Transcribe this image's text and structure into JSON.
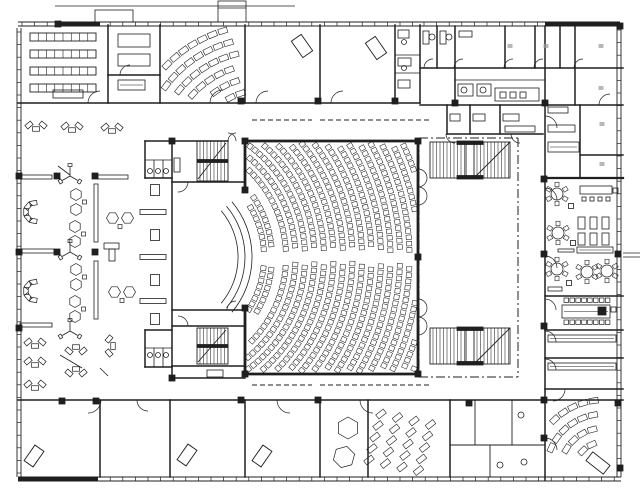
{
  "meta": {
    "canvas_w": 640,
    "canvas_h": 499,
    "ink": "#1f1f1f",
    "paper": "#ffffff",
    "mark": "#9a9a9a",
    "areas": [
      "auditorium",
      "stage",
      "foyer",
      "offices",
      "restaurant",
      "seminar-rooms",
      "sanitary",
      "stair-cores"
    ]
  },
  "facades": [
    {
      "o": "v",
      "p": 19,
      "f": 28,
      "t": 477
    },
    {
      "o": "h",
      "p": 479,
      "f": 18,
      "t": 621
    },
    {
      "o": "v",
      "p": 619,
      "f": 26,
      "t": 477
    },
    {
      "o": "h",
      "p": 24,
      "f": 18,
      "t": 420
    },
    {
      "o": "h",
      "p": 24,
      "f": 420,
      "t": 620
    }
  ],
  "thick": [
    [
      55,
      24,
      100,
      24,
      3
    ],
    [
      545,
      24,
      620,
      24,
      3
    ],
    [
      18,
      479,
      98,
      479,
      4
    ]
  ],
  "walls": [
    [
      18,
      103,
      420,
      103
    ],
    [
      108,
      25,
      108,
      103
    ],
    [
      160,
      25,
      160,
      103
    ],
    [
      108,
      75,
      160,
      75
    ],
    [
      245,
      25,
      245,
      103
    ],
    [
      320,
      25,
      320,
      103
    ],
    [
      395,
      25,
      395,
      103
    ],
    [
      420,
      25,
      420,
      103
    ],
    [
      395,
      55,
      420,
      55,
      0.8
    ],
    [
      395,
      73,
      420,
      73,
      0.8
    ],
    [
      420,
      68,
      623,
      68
    ],
    [
      437,
      26,
      437,
      68
    ],
    [
      455,
      26,
      455,
      105
    ],
    [
      505,
      26,
      505,
      68
    ],
    [
      535,
      26,
      535,
      68
    ],
    [
      560,
      26,
      560,
      68
    ],
    [
      575,
      26,
      575,
      105
    ],
    [
      455,
      80,
      545,
      80,
      0.8
    ],
    [
      420,
      105,
      623,
      105
    ],
    [
      545,
      26,
      545,
      178
    ],
    [
      545,
      178,
      545,
      480
    ],
    [
      447,
      105,
      447,
      134
    ],
    [
      470,
      105,
      470,
      134
    ],
    [
      500,
      105,
      500,
      134
    ],
    [
      447,
      134,
      543,
      134
    ],
    [
      580,
      105,
      580,
      178
    ],
    [
      580,
      155,
      623,
      155
    ],
    [
      545,
      178,
      623,
      178,
      2.2
    ],
    [
      545,
      296,
      623,
      296
    ],
    [
      545,
      330,
      623,
      330
    ],
    [
      545,
      358,
      623,
      358
    ],
    [
      545,
      389,
      623,
      389
    ],
    [
      245,
      141,
      418,
      141,
      2.8
    ],
    [
      418,
      141,
      418,
      374,
      2.8
    ],
    [
      245,
      374,
      418,
      374,
      2.8
    ],
    [
      245,
      141,
      245,
      190,
      2.8
    ],
    [
      245,
      308,
      245,
      374,
      2.8
    ],
    [
      172,
      141,
      172,
      378
    ],
    [
      145,
      141,
      228,
      141
    ],
    [
      243,
      141,
      245,
      141
    ],
    [
      172,
      182,
      245,
      182
    ],
    [
      172,
      310,
      245,
      310
    ],
    [
      172,
      326,
      245,
      326
    ],
    [
      172,
      366,
      245,
      366
    ],
    [
      172,
      378,
      245,
      378
    ],
    [
      145,
      141,
      145,
      178
    ],
    [
      145,
      178,
      172,
      178
    ],
    [
      154,
      160,
      154,
      178,
      0.8
    ],
    [
      163,
      160,
      163,
      178,
      0.8
    ],
    [
      145,
      160,
      172,
      160,
      0.8
    ],
    [
      145,
      330,
      145,
      367
    ],
    [
      145,
      330,
      172,
      330
    ],
    [
      145,
      367,
      172,
      367
    ],
    [
      154,
      348,
      154,
      367,
      0.8
    ],
    [
      163,
      348,
      163,
      367,
      0.8
    ],
    [
      145,
      348,
      172,
      348,
      0.8
    ],
    [
      18,
      400,
      623,
      400
    ],
    [
      100,
      400,
      100,
      477
    ],
    [
      170,
      400,
      170,
      477
    ],
    [
      245,
      400,
      245,
      477
    ],
    [
      320,
      400,
      320,
      477
    ],
    [
      368,
      400,
      368,
      477
    ],
    [
      450,
      400,
      450,
      477
    ],
    [
      475,
      400,
      475,
      445,
      0.9
    ],
    [
      512,
      400,
      512,
      445,
      0.9
    ],
    [
      450,
      445,
      545,
      445,
      0.9
    ],
    [
      490,
      445,
      490,
      477,
      0.9
    ]
  ],
  "dash": [
    [
      252,
      120,
      312,
      120
    ],
    [
      320,
      120,
      430,
      120
    ],
    [
      252,
      385,
      312,
      385
    ],
    [
      320,
      385,
      430,
      385
    ]
  ],
  "dashdot": [
    [
      419,
      138,
      518,
      138
    ],
    [
      518,
      138,
      518,
      377
    ],
    [
      419,
      138,
      419,
      377
    ],
    [
      419,
      377,
      518,
      377
    ]
  ],
  "stairs": [
    {
      "x": 197,
      "y": 141,
      "w": 31,
      "h": 40,
      "gap": 0
    },
    {
      "x": 197,
      "y": 328,
      "w": 31,
      "h": 36,
      "gap": 0
    },
    {
      "x": 430,
      "y": 142,
      "w": 80,
      "h": 36,
      "gap": 1
    },
    {
      "x": 430,
      "y": 328,
      "w": 80,
      "h": 36,
      "gap": 1
    }
  ],
  "rects": [
    [
      95,
      10,
      38,
      12,
      0
    ],
    [
      218,
      1,
      28,
      21,
      0
    ],
    [
      118,
      34,
      32,
      13,
      0
    ],
    [
      118,
      54,
      32,
      12,
      0
    ],
    [
      118,
      80,
      27,
      10,
      1
    ],
    [
      53,
      90,
      30,
      8,
      0
    ],
    [
      423,
      31,
      6,
      13,
      0
    ],
    [
      440,
      31,
      6,
      13,
      0
    ],
    [
      459,
      31,
      13,
      6,
      0
    ],
    [
      458,
      84,
      15,
      12,
      0
    ],
    [
      477,
      84,
      14,
      12,
      0
    ],
    [
      495,
      88,
      44,
      13,
      0
    ],
    [
      500,
      92,
      6,
      6,
      0
    ],
    [
      510,
      92,
      6,
      6,
      0
    ],
    [
      520,
      92,
      6,
      6,
      0
    ],
    [
      450,
      114,
      10,
      7,
      0
    ],
    [
      473,
      114,
      12,
      7,
      0
    ],
    [
      503,
      114,
      16,
      7,
      0
    ],
    [
      505,
      126,
      30,
      6,
      0
    ],
    [
      398,
      30,
      11,
      8,
      0
    ],
    [
      398,
      58,
      13,
      8,
      0
    ],
    [
      398,
      80,
      12,
      8,
      0
    ],
    [
      548,
      107,
      20,
      6,
      0
    ],
    [
      548,
      125,
      27,
      7,
      0
    ],
    [
      548,
      142,
      31,
      10,
      1
    ],
    [
      580,
      186,
      32,
      8,
      0
    ],
    [
      582,
      197,
      4,
      4,
      0
    ],
    [
      590,
      197,
      4,
      4,
      0
    ],
    [
      598,
      197,
      4,
      4,
      0
    ],
    [
      606,
      197,
      4,
      4,
      0
    ],
    [
      613,
      188,
      5,
      5,
      0
    ],
    [
      578,
      217,
      7,
      12,
      0
    ],
    [
      590,
      217,
      7,
      12,
      0
    ],
    [
      602,
      217,
      7,
      12,
      0
    ],
    [
      578,
      233,
      7,
      12,
      0
    ],
    [
      590,
      233,
      7,
      12,
      0
    ],
    [
      602,
      233,
      7,
      12,
      0
    ],
    [
      577,
      247,
      36,
      6,
      1
    ],
    [
      558,
      249,
      16,
      3,
      0
    ],
    [
      562,
      305,
      48,
      13,
      1
    ],
    [
      598,
      307,
      8,
      8,
      2
    ],
    [
      611,
      307,
      5,
      5,
      0
    ],
    [
      548,
      287,
      14,
      4,
      0
    ],
    [
      548,
      335,
      68,
      7,
      1
    ],
    [
      548,
      363,
      68,
      7,
      1
    ],
    [
      207,
      370,
      16,
      7,
      0
    ],
    [
      174,
      158,
      6,
      14,
      0
    ]
  ],
  "squares": [
    [
      58,
      24
    ],
    [
      241,
      101
    ],
    [
      318,
      101
    ],
    [
      395,
      101
    ],
    [
      455,
      103
    ],
    [
      545,
      103
    ],
    [
      620,
      26
    ],
    [
      19,
      176
    ],
    [
      19,
      252
    ],
    [
      19,
      328
    ],
    [
      57,
      176
    ],
    [
      95,
      176
    ],
    [
      57,
      252
    ],
    [
      95,
      252
    ],
    [
      245,
      141
    ],
    [
      418,
      141
    ],
    [
      418,
      257
    ],
    [
      418,
      374
    ],
    [
      245,
      374
    ],
    [
      245,
      190
    ],
    [
      245,
      308
    ],
    [
      544,
      179
    ],
    [
      544,
      254
    ],
    [
      544,
      326
    ],
    [
      544,
      400
    ],
    [
      544,
      438
    ],
    [
      618,
      254
    ],
    [
      618,
      403
    ],
    [
      620,
      468
    ],
    [
      62,
      401
    ],
    [
      96,
      401
    ],
    [
      241,
      400
    ],
    [
      318,
      400
    ],
    [
      469,
      403
    ],
    [
      172,
      141
    ],
    [
      172,
      378
    ]
  ],
  "marks": [
    [
      510,
      46
    ],
    [
      546,
      46
    ],
    [
      601,
      46
    ],
    [
      601,
      88
    ],
    [
      602,
      124
    ],
    [
      602,
      164
    ]
  ],
  "circles": [
    [
      432,
      37,
      3
    ],
    [
      449,
      37,
      3
    ],
    [
      464,
      90,
      3
    ],
    [
      483,
      90,
      3
    ],
    [
      404,
      42,
      2.5
    ],
    [
      404,
      68,
      2.5
    ],
    [
      150,
      171,
      2.5
    ],
    [
      158,
      171,
      2.5
    ],
    [
      166,
      171,
      2.5
    ],
    [
      150,
      355,
      2.5
    ],
    [
      158,
      355,
      2.5
    ],
    [
      166,
      355,
      2.5
    ],
    [
      521,
      415,
      3
    ],
    [
      500,
      465,
      3
    ],
    [
      524,
      462,
      3
    ]
  ],
  "doors": [
    [
      100,
      103,
      12,
      180,
      270
    ],
    [
      130,
      75,
      10,
      180,
      270
    ],
    [
      223,
      103,
      13,
      180,
      270
    ],
    [
      268,
      103,
      12,
      180,
      270
    ],
    [
      343,
      103,
      12,
      180,
      270
    ],
    [
      236,
      141,
      8,
      180,
      270
    ],
    [
      228,
      141,
      8,
      270,
      360
    ],
    [
      178,
      182,
      10,
      0,
      90
    ],
    [
      178,
      326,
      10,
      270,
      360
    ],
    [
      236,
      310,
      9,
      180,
      270
    ],
    [
      88,
      400,
      13,
      0,
      90
    ],
    [
      148,
      400,
      11,
      90,
      180
    ],
    [
      290,
      400,
      13,
      90,
      180
    ],
    [
      373,
      400,
      13,
      90,
      180
    ],
    [
      553,
      389,
      12,
      0,
      90
    ],
    [
      545,
      200,
      12,
      270,
      360
    ],
    [
      545,
      268,
      12,
      270,
      360
    ],
    [
      545,
      310,
      11,
      270,
      360
    ],
    [
      545,
      342,
      11,
      270,
      360
    ],
    [
      545,
      370,
      11,
      270,
      360
    ],
    [
      545,
      450,
      12,
      270,
      360
    ],
    [
      545,
      128,
      12,
      270,
      360
    ],
    [
      433,
      68,
      9,
      180,
      270
    ],
    [
      463,
      68,
      9,
      180,
      270
    ],
    [
      513,
      68,
      9,
      180,
      270
    ],
    [
      543,
      68,
      9,
      180,
      270
    ],
    [
      583,
      68,
      9,
      180,
      270
    ],
    [
      610,
      105,
      11,
      180,
      270
    ],
    [
      418,
      178,
      9,
      270,
      450
    ],
    [
      418,
      196,
      9,
      270,
      450
    ],
    [
      418,
      308,
      9,
      270,
      450
    ],
    [
      418,
      326,
      9,
      270,
      450
    ],
    [
      455,
      134,
      9,
      90,
      180
    ],
    [
      520,
      134,
      9,
      90,
      180
    ]
  ],
  "auditorium": {
    "cx": 166,
    "cy": 257,
    "frontR": [
      98,
      106
    ],
    "frontMaxA": 34,
    "mainR0": 120,
    "mainDr": 9.5,
    "mainN": 17,
    "maxA": 58,
    "clip": [
      248,
      144,
      415,
      371
    ],
    "aisleHalf": 6.5,
    "seatW": 5.2,
    "seatH": 4.6,
    "sp": 6.3
  },
  "platform": {
    "cx": 166,
    "cy": 257,
    "radii": [
      72,
      79,
      86
    ],
    "a0": -40,
    "a1": 40
  },
  "fans": [
    {
      "cx": 262,
      "cy": 158,
      "radii": [
        68,
        81,
        94,
        107,
        120,
        133
      ],
      "a0": 196,
      "a1": 256,
      "sp": 11,
      "w": 9,
      "h": 5.5,
      "clip": [
        163,
        28,
        242,
        98
      ]
    },
    {
      "cx": 604,
      "cy": 472,
      "radii": [
        30,
        44,
        58,
        72
      ],
      "a0": 183,
      "a1": 262,
      "sp": 11,
      "w": 9,
      "h": 5.5,
      "clip": [
        548,
        396,
        616,
        458
      ]
    }
  ],
  "grids": [
    {
      "x0": 381,
      "y0": 414,
      "cols": 4,
      "rows": 5,
      "dx": 16.5,
      "dy": 11.5,
      "sx": -3,
      "sy": 3.5,
      "w": 9.5,
      "h": 5,
      "rot": -38
    }
  ],
  "segTables": {
    "x": 30,
    "w": 66,
    "h": 8,
    "cells": 8,
    "ys": [
      33,
      50,
      67,
      84
    ]
  },
  "chairRows": [
    {
      "x0": 564,
      "y0": 298,
      "n": 8,
      "dx": 5.9,
      "w": 4.6,
      "h": 4.4
    },
    {
      "x0": 564,
      "y0": 320,
      "n": 8,
      "dx": 5.9,
      "w": 4.6,
      "h": 4.4
    }
  ],
  "roundTables": [
    [
      557,
      194
    ],
    [
      558,
      233
    ],
    [
      557,
      269
    ],
    [
      587,
      272
    ],
    [
      607,
      271
    ]
  ],
  "furniture": [
    [
      "u",
      36,
      126,
      0
    ],
    [
      "u",
      72,
      127,
      0
    ],
    [
      "u",
      112,
      128,
      0
    ],
    [
      "bench",
      36,
      177,
      0,
      32,
      4
    ],
    [
      "c",
      35,
      212,
      0
    ],
    [
      "bench",
      38,
      251,
      0,
      32,
      4
    ],
    [
      "c",
      35,
      291,
      0
    ],
    [
      "bench",
      36,
      325,
      0,
      32,
      4
    ],
    [
      "u",
      35,
      343,
      0
    ],
    [
      "u",
      35,
      362,
      0
    ],
    [
      "u",
      35,
      385,
      0
    ],
    [
      "y",
      70,
      176,
      0
    ],
    [
      "hex2",
      76,
      202,
      0
    ],
    [
      "hex2",
      75,
      234,
      0
    ],
    [
      "y",
      70,
      252,
      0
    ],
    [
      "hex2",
      76,
      277,
      0
    ],
    [
      "hex2",
      75,
      309,
      0
    ],
    [
      "y",
      70,
      331,
      0
    ],
    [
      "u",
      76,
      350,
      180
    ],
    [
      "u",
      76,
      372,
      180
    ],
    [
      "bench",
      113,
      177,
      0,
      30,
      4
    ],
    [
      "hex2",
      120,
      218,
      90
    ],
    [
      "L",
      112,
      252,
      0
    ],
    [
      "hex2",
      122,
      292,
      90
    ],
    [
      "u",
      110,
      346,
      270
    ],
    [
      "benchv",
      96,
      213,
      0,
      4,
      58
    ],
    [
      "benchv",
      96,
      290,
      0,
      4,
      58
    ],
    [
      "sq",
      155,
      190,
      0,
      9,
      11
    ],
    [
      "bench",
      153,
      212,
      0,
      26,
      5
    ],
    [
      "sq",
      155,
      235,
      0,
      9,
      11
    ],
    [
      "bench",
      153,
      257,
      0,
      26,
      5
    ],
    [
      "sq",
      155,
      280,
      0,
      9,
      11
    ],
    [
      "bench",
      153,
      301,
      0,
      26,
      5
    ],
    [
      "sq",
      155,
      319,
      0,
      9,
      11
    ],
    [
      "desk",
      34,
      456,
      35,
      11,
      19
    ],
    [
      "desk",
      187,
      455,
      35,
      11,
      19
    ],
    [
      "desk",
      262,
      456,
      35,
      11,
      19
    ],
    [
      "desk",
      302,
      46,
      -35,
      12,
      20
    ],
    [
      "desk",
      376,
      48,
      -35,
      12,
      20
    ],
    [
      "desk",
      598,
      463,
      38,
      22,
      11
    ],
    [
      "hexT",
      348,
      428,
      0
    ],
    [
      "hexT",
      344,
      457,
      15
    ],
    [
      "sq",
      571,
      206,
      0,
      5,
      5
    ],
    [
      "sq",
      573,
      243,
      0,
      5,
      5
    ],
    [
      "sq",
      569,
      283,
      0,
      5,
      5
    ]
  ],
  "lines": [
    [
      60,
      355,
      82,
      368
    ],
    [
      100,
      368,
      108,
      376
    ],
    [
      58,
      166,
      70,
      175
    ],
    [
      623,
      253,
      640,
      253
    ],
    [
      623,
      257,
      640,
      257
    ],
    [
      55,
      6,
      295,
      6
    ],
    [
      218,
      8,
      246,
      8
    ]
  ]
}
